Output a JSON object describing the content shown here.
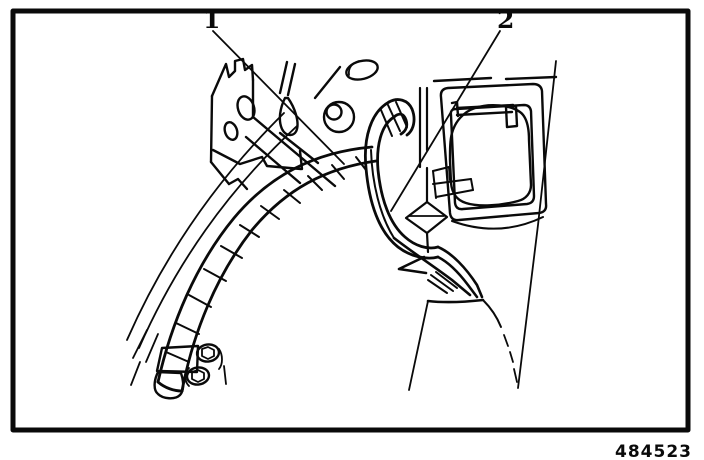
{
  "figure": {
    "callout_1": "1",
    "callout_2": "2",
    "figure_number": "484523"
  },
  "colors": {
    "ink": "#0a0a0a",
    "paper": "#ffffff"
  }
}
